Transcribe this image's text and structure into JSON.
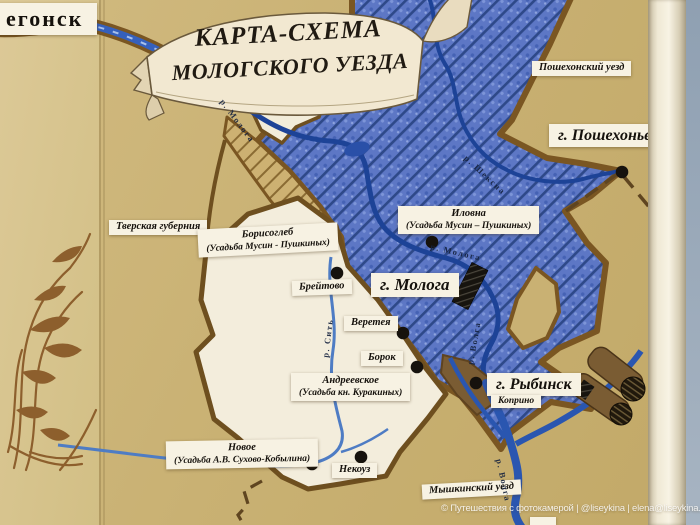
{
  "banner": {
    "line1": "КАРТА-СХЕМА",
    "line2": "МОЛОГСКОГО УЕЗДА"
  },
  "corner_city": "егонск",
  "regions": {
    "poshekhonsky_uezd": "Пошехонский уезд",
    "tverskaya_gubernia": "Тверская губерния",
    "myshkinsky_uezd": "Мышкинский уезд"
  },
  "cities": {
    "poshekhonye": "г. Пошехонье",
    "mologa": "г. Молога",
    "rybinsk": "г. Рыбинск"
  },
  "settlements": {
    "borisogleb": {
      "line1": "Борисоглеб",
      "line2": "(Усадьба Мусин - Пушкиных)"
    },
    "ilovna": {
      "line1": "Иловна",
      "line2": "(Усадьба Мусин – Пушкиных)"
    },
    "breytovo": "Брейтово",
    "vereteya": "Веретея",
    "borok": "Борок",
    "andreevskoe": {
      "line1": "Андреевское",
      "line2": "(Усадьба кн. Куракиных)"
    },
    "novoe": {
      "line1": "Новое",
      "line2": "(Усадьба А.В. Сухово-Кобылина)"
    },
    "nekouz": "Некоуз",
    "koprino": "Коприно"
  },
  "rivers": {
    "mologa_upper": "р. Молога",
    "mologa_middle": "р. Молога",
    "sheksna": "р. Шексна",
    "sit": "р. Сить",
    "volga": "р. Волга",
    "volga_west": "р. Волга"
  },
  "watermark": "© Путешествия с фотокамерой | @liseykina | elena@liseykina.ru",
  "colors": {
    "wall": "#c9b173",
    "wall_left_panel": "#d6c48e",
    "reservoir_blue": "#5d77c5",
    "hatch_blue": "#26417f",
    "river_blue": "#2a56b0",
    "border_brown": "#7a5622",
    "land_white": "#f3eddc",
    "banner_cream": "#f2e8d1",
    "label_paper": "#f7f2e3",
    "marker_black": "#16120d",
    "door_trim": "#f3ecdb",
    "wall_right": "#9aa9b8"
  }
}
